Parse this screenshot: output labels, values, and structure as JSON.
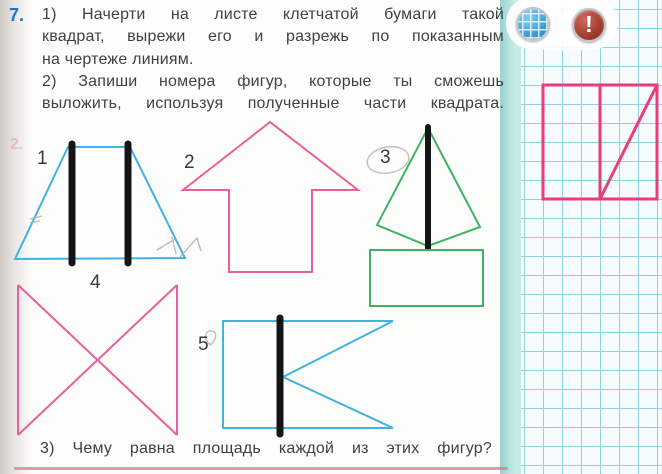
{
  "task_number": "7.",
  "instructions": {
    "part1_lines": [
      "1) Начерти на листе клетчатой бумаги такой",
      "квадрат, вырежи его и разрежь по показанным",
      "на чертеже линиям."
    ],
    "part2_lines": [
      "2) Запиши номера фигур, которые ты сможешь",
      "выложить, используя полученные части квадрата."
    ],
    "part3": "3) Чему равна площадь каждой из этих фигур?"
  },
  "figures": [
    {
      "label": "1",
      "shape": "trapezoid-with-two-vertical-cut-lines",
      "color": "#42b2e2"
    },
    {
      "label": "2",
      "shape": "up-arrow",
      "color": "#ea5f9b"
    },
    {
      "label": "3",
      "shape": "kite-with-vertical-cut-line-and-rectangle",
      "color": "#3eb364"
    },
    {
      "label": "4",
      "shape": "bowtie",
      "color": "#ea5f9b"
    },
    {
      "label": "5",
      "shape": "flag-with-vertical-cut-line",
      "color": "#42b2e2"
    }
  ],
  "margin_show_through": "2.",
  "sidebar": {
    "grid_icon": "squared-paper",
    "alert_icon_glyph": "!",
    "diagram": {
      "description": "pink square 6x6 cells, vertical cut in the middle, diagonal cut from bottom-middle to top-right corner",
      "color": "#e83d7a"
    }
  },
  "colors": {
    "task_number": "#2073c8",
    "body_text": "#414141",
    "cut_line": "#151515",
    "grid_line": "#8fd3e2",
    "panel_strip": "#b0e2da",
    "bottom_rule": "#e2738f"
  }
}
